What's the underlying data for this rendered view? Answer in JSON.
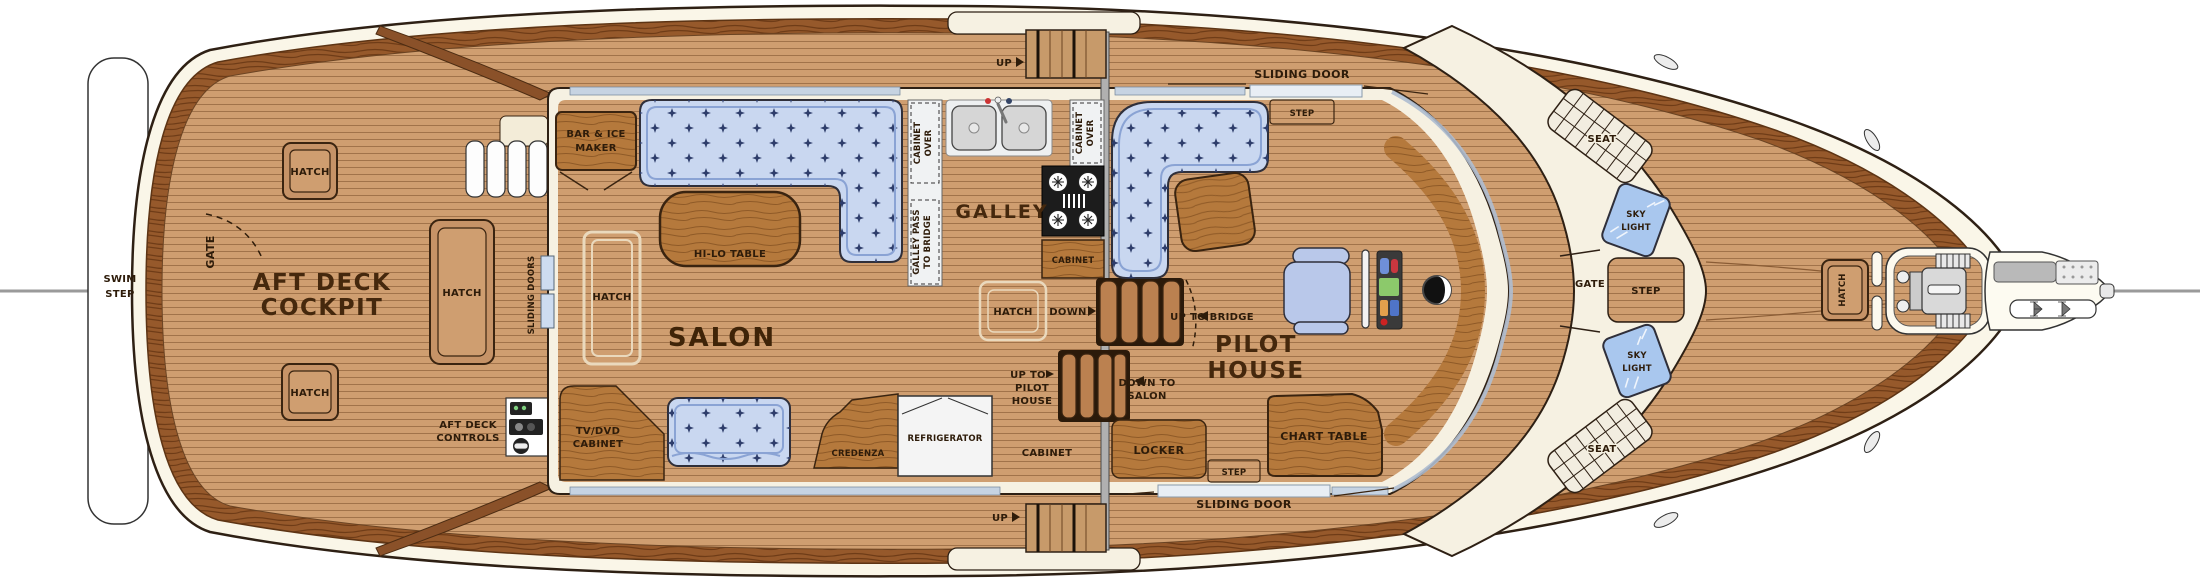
{
  "meta": {
    "title": "Yacht Main Deck Floor Plan"
  },
  "colors": {
    "teak": "#cf9e70",
    "plank_line": "#a1734a",
    "caprail": "#96592b",
    "hull_cream": "#faf6e8",
    "superstructure": "#f6f1e2",
    "upholstery_blue": "#c9d7f0",
    "upholstery_accent": "#8aa3d4",
    "furniture_wood": "#b5793c",
    "skylight_blue": "#a9c7ee",
    "stove_black": "#1c1c1c",
    "label_ink": "#2e1c0a"
  },
  "stern": {
    "swim_line1": "SWIM",
    "swim_line2": "STEP",
    "gate": "GATE"
  },
  "aft_deck": {
    "title1": "AFT DECK",
    "title2": "COCKPIT",
    "hatch_top": "HATCH",
    "hatch_bottom": "HATCH",
    "hatch_side": "HATCH",
    "controls1": "AFT DECK",
    "controls2": "CONTROLS",
    "sliding_doors": "SLIDING DOORS"
  },
  "salon": {
    "title": "SALON",
    "bar1": "BAR & ICE",
    "bar2": "MAKER",
    "hilo": "HI-LO TABLE",
    "hatch": "HATCH",
    "tv1": "TV/DVD",
    "tv2": "CABINET",
    "credenza": "CREDENZA",
    "refrigerator": "REFRIGERATOR"
  },
  "galley": {
    "title": "GALLEY",
    "cab_over_l1": "CABINET",
    "cab_over_l2": "OVER",
    "cab_over_r1": "CABINET",
    "cab_over_r2": "OVER",
    "pass1": "GALLEY PASS",
    "pass2": "TO BRIDGE",
    "cabinet": "CABINET"
  },
  "midship": {
    "up_top": "UP",
    "up_bottom": "UP",
    "hatch": "HATCH",
    "down": "DOWN",
    "up_to": "UP TO",
    "up_to1": "PILOT",
    "up_to2": "HOUSE",
    "down_to1": "DOWN TO",
    "down_to2": "SALON",
    "cabinet": "CABINET"
  },
  "pilot_house": {
    "title1": "PILOT",
    "title2": "HOUSE",
    "up_to_bridge": "UP TO BRIDGE",
    "chart_table": "CHART TABLE",
    "locker": "LOCKER",
    "door_top": "SLIDING DOOR",
    "door_bottom": "SLIDING DOOR",
    "step_top": "STEP",
    "step_bottom": "STEP"
  },
  "bridge_deck": {
    "gate": "GATE",
    "step": "STEP",
    "sky1": "SKY",
    "sky2": "LIGHT",
    "seat_top": "SEAT",
    "seat_bottom": "SEAT"
  },
  "foredeck": {
    "hatch": "HATCH"
  }
}
